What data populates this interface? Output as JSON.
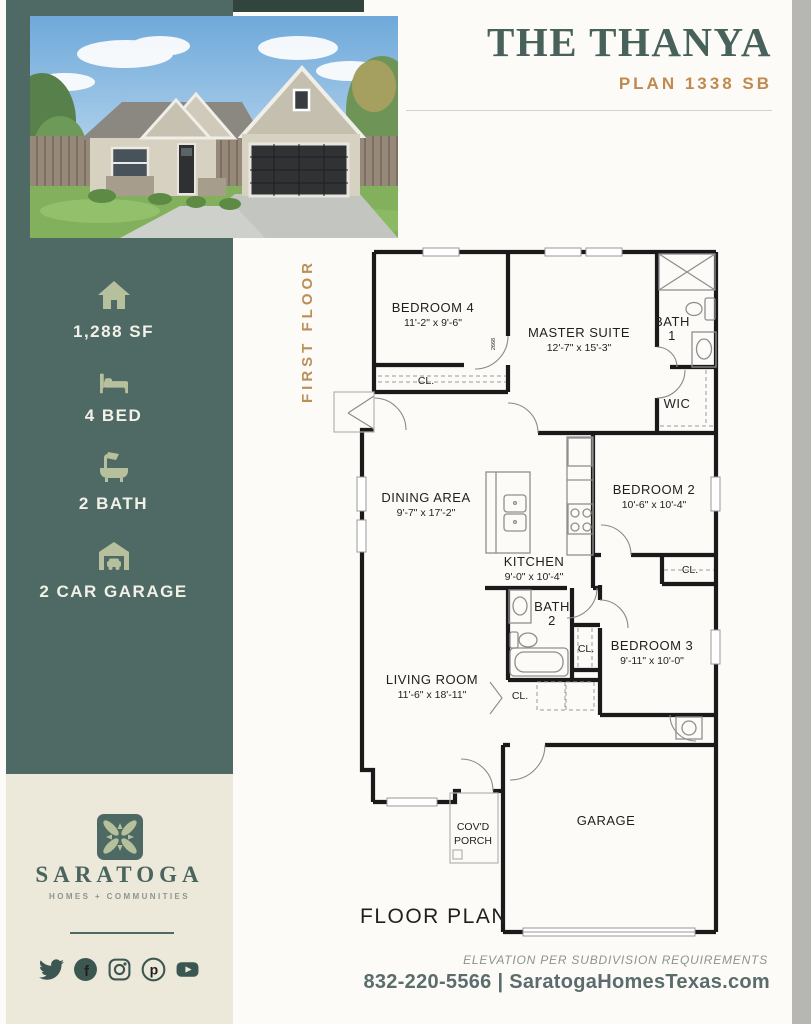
{
  "header": {
    "title": "THE THANYA",
    "plan_label": "PLAN 1338 SB"
  },
  "sidebar": {
    "bg_color": "#4f6a65",
    "accent_color": "#b7c09c",
    "stats": [
      {
        "icon": "home-icon",
        "label": "1,288 SF"
      },
      {
        "icon": "bed-icon",
        "label": "4 BED"
      },
      {
        "icon": "bath-icon",
        "label": "2 BATH"
      },
      {
        "icon": "garage-icon",
        "label": "2 CAR GARAGE"
      }
    ]
  },
  "brand": {
    "panel_bg": "#ece8da",
    "logo_icon": "pinwheel-leaf-logo",
    "name": "SARATOGA",
    "tagline": "HOMES + COMMUNITIES",
    "social_icons": [
      "twitter-icon",
      "facebook-icon",
      "instagram-icon",
      "pinterest-icon",
      "youtube-icon"
    ],
    "glyphs": {
      "facebook": "f",
      "pinterest": "p"
    }
  },
  "floorplan": {
    "floor_label": "FIRST FLOOR",
    "caption": "FLOOR PLAN",
    "door_tag": "2668",
    "closet_label": "CL.",
    "rooms": {
      "bedroom4": {
        "name": "BEDROOM 4",
        "dims": "11'-2\" x 9'-6\""
      },
      "master": {
        "name": "MASTER SUITE",
        "dims": "12'-7\" x 15'-3\""
      },
      "bath1": {
        "name": "BATH",
        "number": "1"
      },
      "wic": {
        "name": "WIC"
      },
      "dining": {
        "name": "DINING AREA",
        "dims": "9'-7\" x 17'-2\""
      },
      "kitchen": {
        "name": "KITCHEN",
        "dims": "9'-0\" x 10'-4\""
      },
      "bedroom2": {
        "name": "BEDROOM 2",
        "dims": "10'-6\" x 10'-4\""
      },
      "bath2": {
        "name": "BATH",
        "number": "2"
      },
      "bedroom3": {
        "name": "BEDROOM 3",
        "dims": "9'-11\" x 10'-0\""
      },
      "living": {
        "name": "LIVING ROOM",
        "dims": "11'-6\" x 18'-11\""
      },
      "garage": {
        "name": "GARAGE"
      },
      "porch": {
        "name": "COV'D",
        "name2": "PORCH"
      }
    }
  },
  "footer": {
    "note": "ELEVATION PER SUBDIVISION REQUIREMENTS",
    "contact": "832-220-5566 | SaratogaHomesTexas.com"
  }
}
